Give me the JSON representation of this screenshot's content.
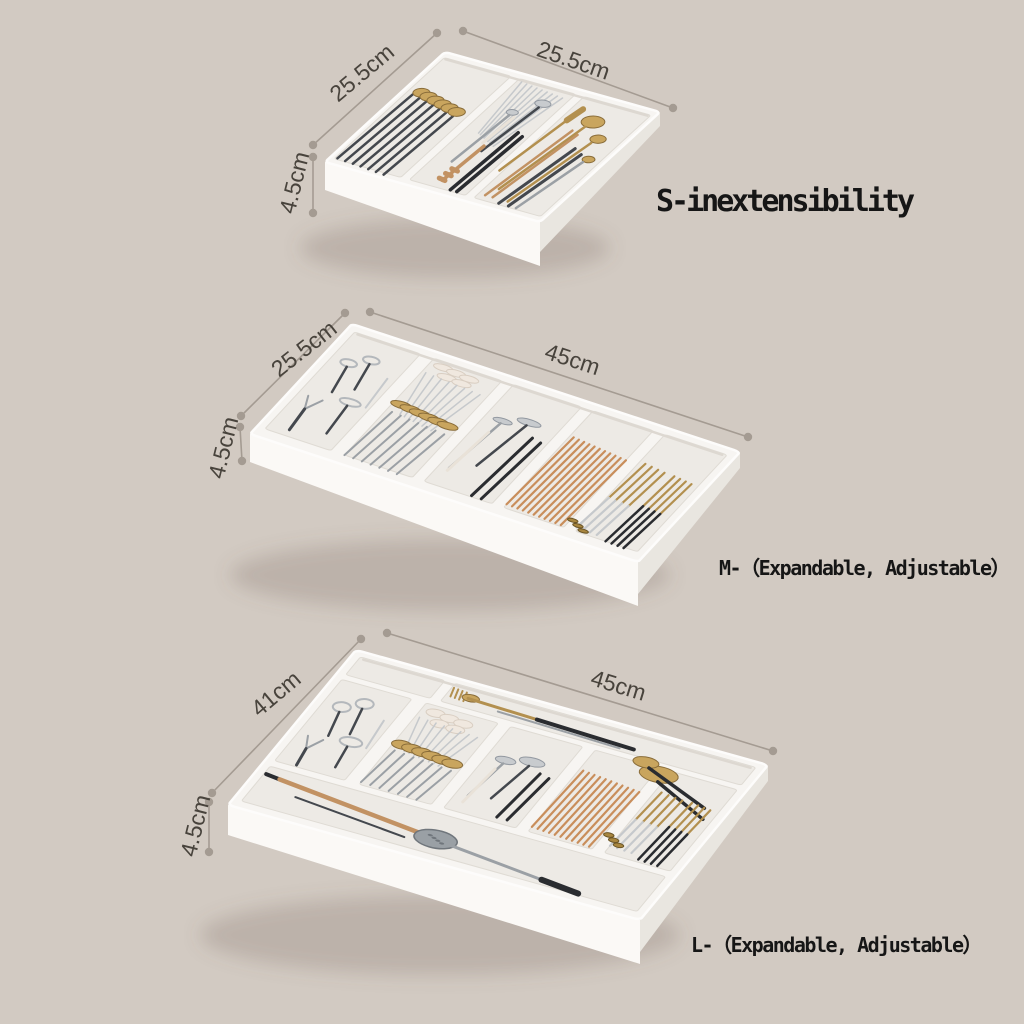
{
  "page": {
    "background": "#d2cac2"
  },
  "products": [
    {
      "id": "small",
      "label": "S-inextensibility",
      "dims": {
        "depth": "25.5cm",
        "width": "25.5cm",
        "height": "4.5cm"
      }
    },
    {
      "id": "medium",
      "label": "M-（Expandable, Adjustable）",
      "dims": {
        "depth": "25.5cm",
        "width": "45cm",
        "height": "4.5cm"
      }
    },
    {
      "id": "large",
      "label": "L-（Expandable, Adjustable）",
      "dims": {
        "depth": "41cm",
        "width": "45cm",
        "height": "4.5cm"
      }
    }
  ],
  "colors": {
    "background": "#d2cac2",
    "tray_white": "#f7f5f2",
    "compartment_floor": "#edeae5",
    "dimension_gray": "#a49b92",
    "label_text": "#161616",
    "dim_text": "#48433c",
    "gold": "#b3904f",
    "silver": "#c6c9cc",
    "steel": "#9ba0a5",
    "dark_handle": "#44484e",
    "black": "#2a2c30",
    "copper_chopstick": "#c98e5b",
    "wood": "#c29263",
    "egg_cream": "#f0e8df"
  }
}
